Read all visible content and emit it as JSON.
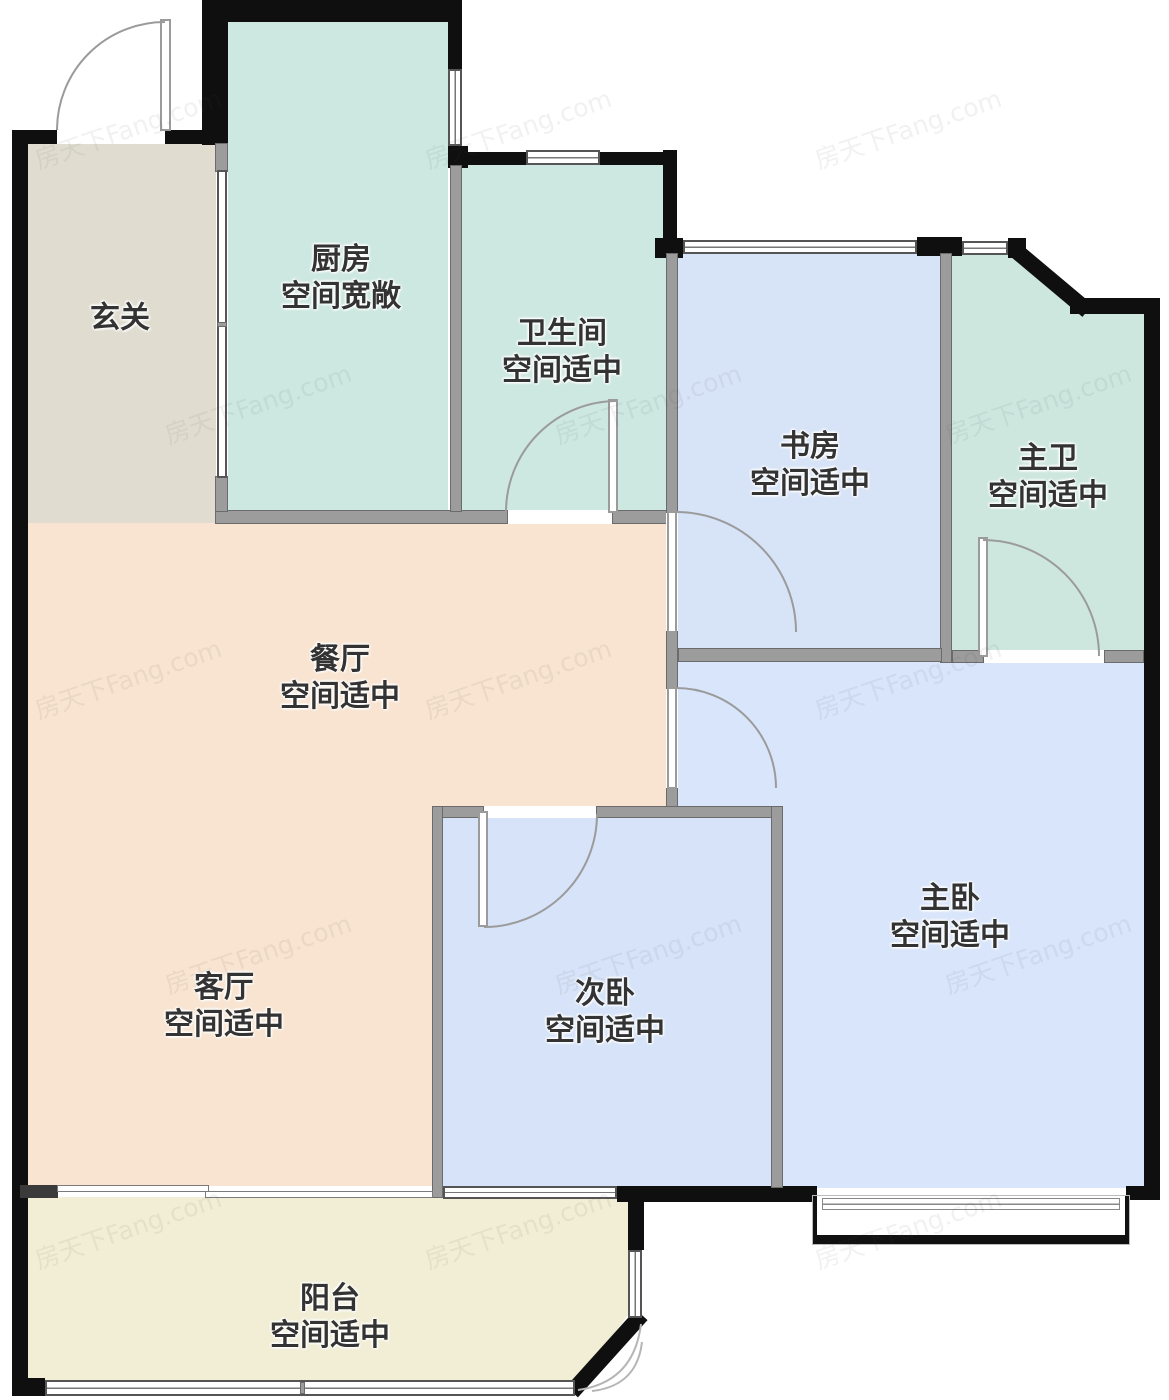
{
  "title": "户型图",
  "watermark": {
    "text": "房天下Fang.com"
  },
  "colors": {
    "exterior_wall": "#0f0f0f",
    "interior_wall": "#9c9c9c",
    "door_arc": "#9b9b9b",
    "label_text": "#333333",
    "foyer": "#e0ddd0",
    "kitchen": "#cde8e1",
    "bathroom": "#cde8e1",
    "study": "#d7e3f7",
    "master_bathroom": "#cde7df",
    "dining_living": "#f8e4d0",
    "bedroom2": "#d6e3f8",
    "master_bedroom": "#d8e5fa",
    "balcony": "#f1eed5"
  },
  "rooms": [
    {
      "id": "foyer",
      "name": "玄关",
      "note": "",
      "color": "#e0ddd0"
    },
    {
      "id": "kitchen",
      "name": "厨房",
      "note": "空间宽敞",
      "color": "#cde8e1"
    },
    {
      "id": "bathroom",
      "name": "卫生间",
      "note": "空间适中",
      "color": "#cde8e1"
    },
    {
      "id": "study",
      "name": "书房",
      "note": "空间适中",
      "color": "#d7e3f7"
    },
    {
      "id": "master-bathroom",
      "name": "主卫",
      "note": "空间适中",
      "color": "#cde7df"
    },
    {
      "id": "dining",
      "name": "餐厅",
      "note": "空间适中",
      "color": "#f8e4d0"
    },
    {
      "id": "living",
      "name": "客厅",
      "note": "空间适中",
      "color": "#f8e4d0"
    },
    {
      "id": "bedroom2",
      "name": "次卧",
      "note": "空间适中",
      "color": "#d6e3f8"
    },
    {
      "id": "master-bedroom",
      "name": "主卧",
      "note": "空间适中",
      "color": "#d8e5fa"
    },
    {
      "id": "balcony",
      "name": "阳台",
      "note": "空间适中",
      "color": "#f1eed5"
    }
  ]
}
